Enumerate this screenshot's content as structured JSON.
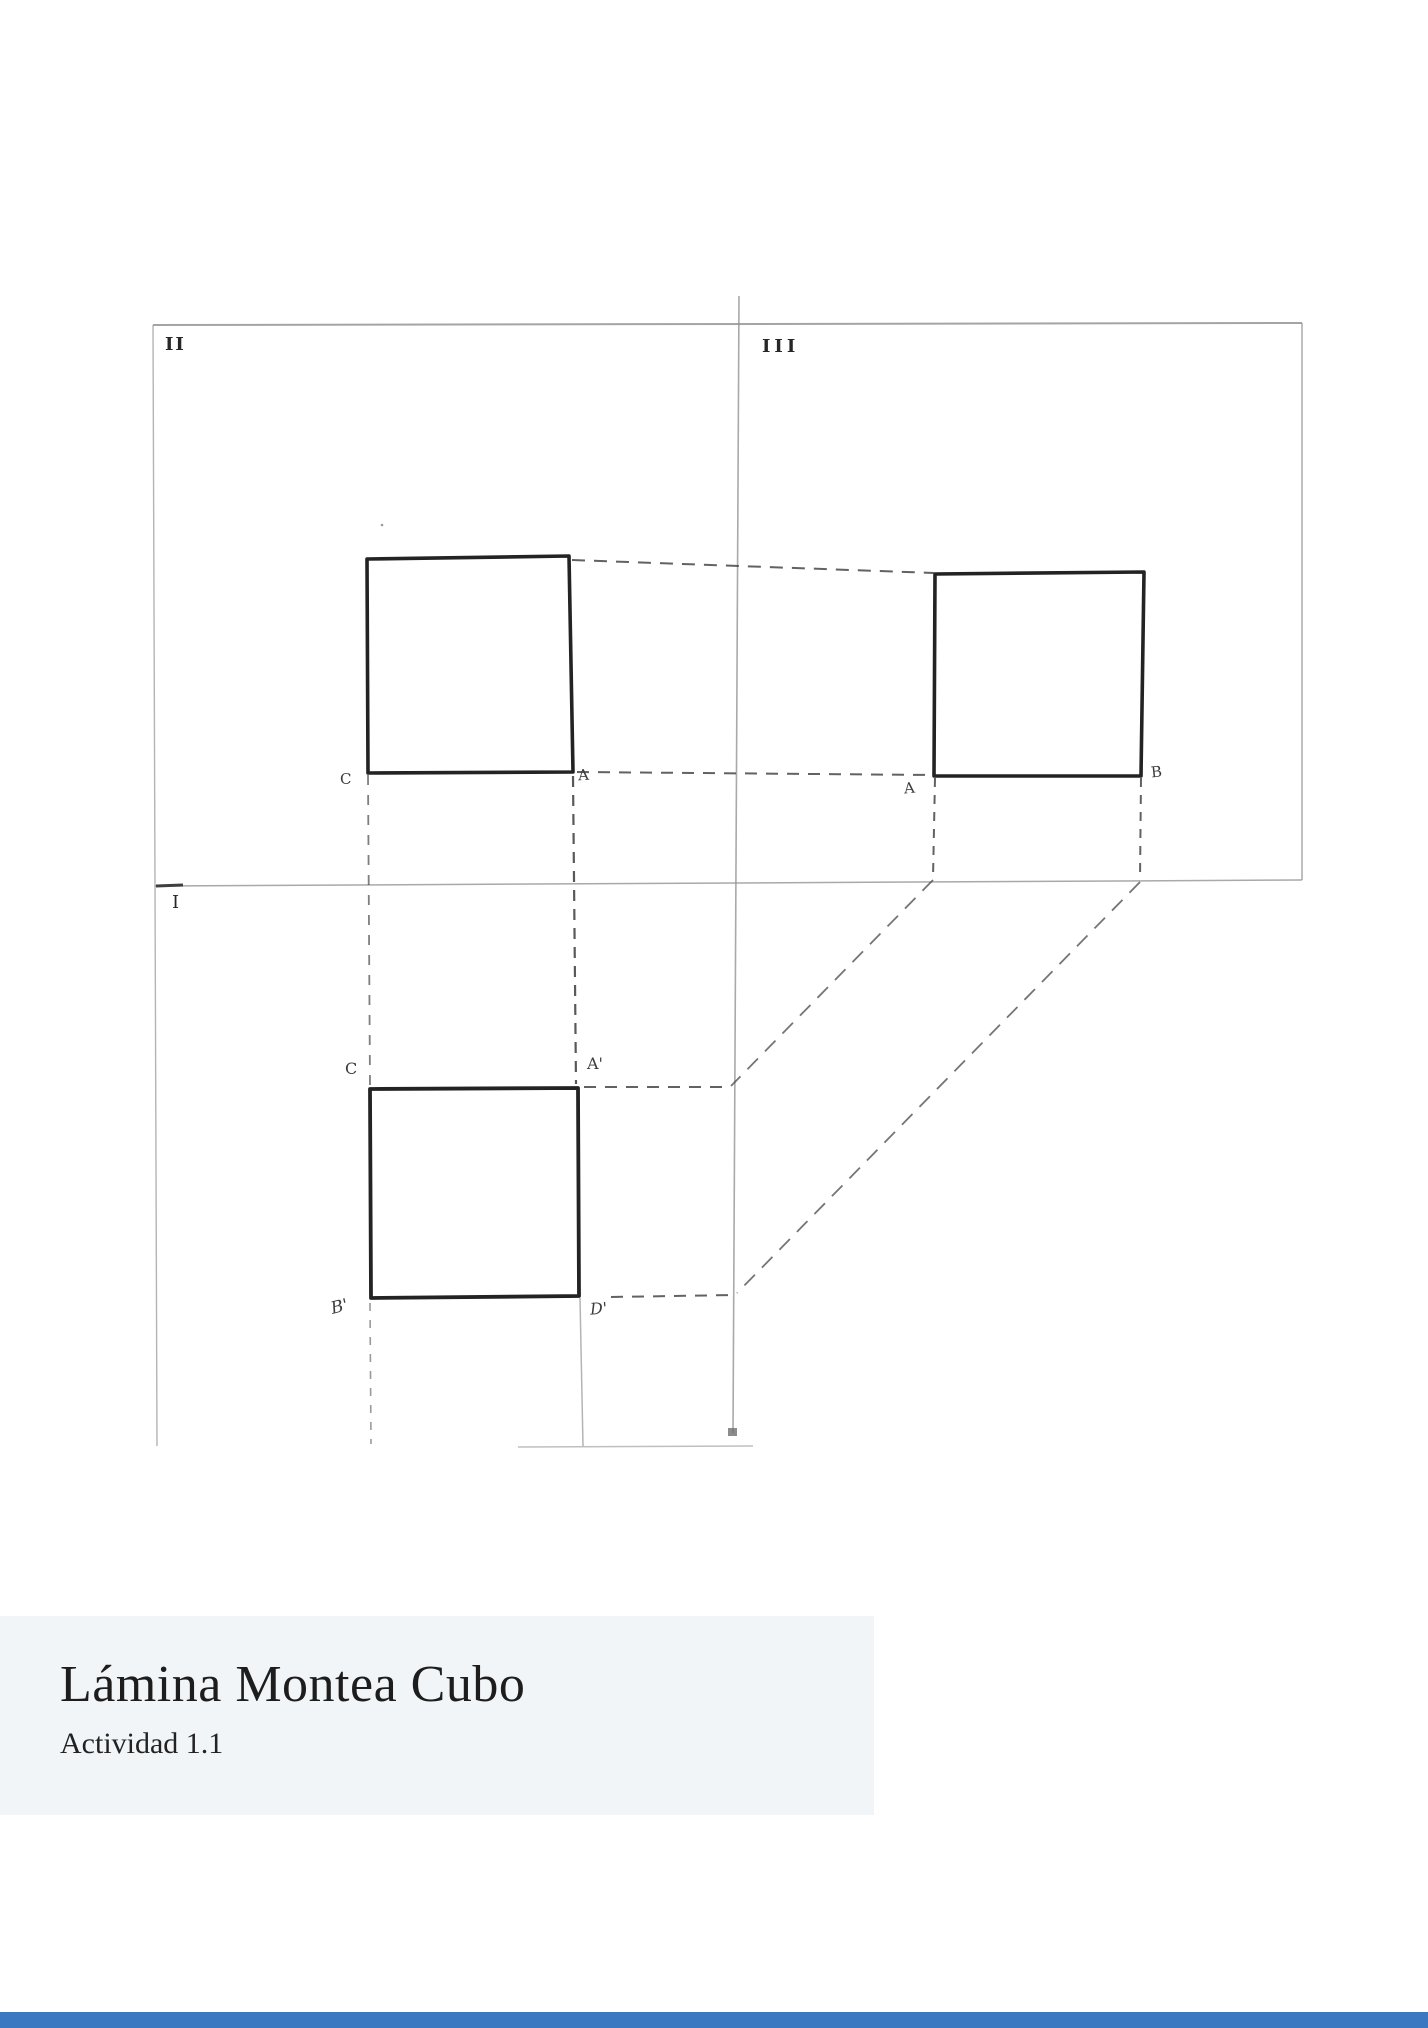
{
  "document": {
    "title": "Lámina Montea Cubo",
    "subtitle": "Actividad 1.1"
  },
  "drawing": {
    "quadrants": {
      "q2": "II",
      "q3": "III",
      "q1": "I"
    },
    "points": {
      "front_c": "C",
      "front_a": "A",
      "side_a": "A",
      "side_b": "B",
      "plan_c": "C",
      "plan_a": "A'",
      "plan_b": "B'",
      "plan_d": "D'"
    },
    "colors": {
      "heavy_line": "#232323",
      "construction_line": "#474747",
      "axis_line": "#949494",
      "paper": "#ffffff"
    }
  },
  "title_block": {
    "background": "#f2f5f8",
    "text_color": "#1d1d1d"
  },
  "footer_bar": {
    "color": "#3a78c2"
  }
}
